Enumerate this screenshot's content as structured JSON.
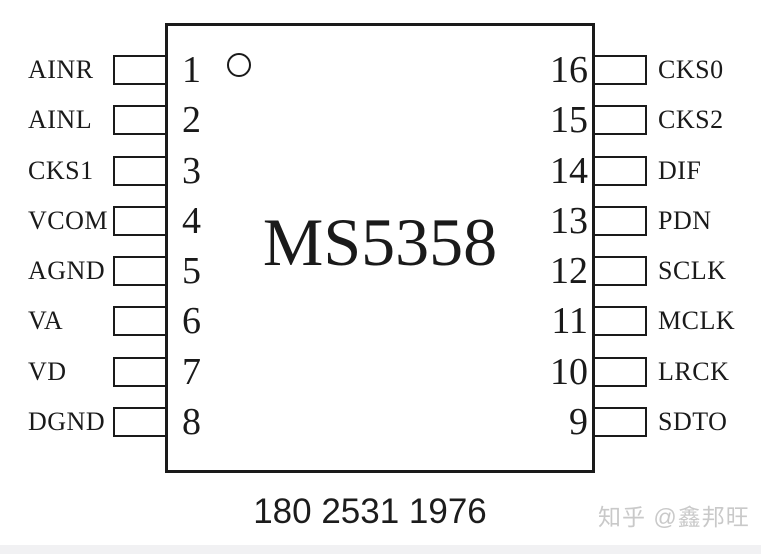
{
  "chip": {
    "title": "MS5358"
  },
  "pins": {
    "left": [
      {
        "number": "1",
        "label": "AINR"
      },
      {
        "number": "2",
        "label": "AINL"
      },
      {
        "number": "3",
        "label": "CKS1"
      },
      {
        "number": "4",
        "label": "VCOM"
      },
      {
        "number": "5",
        "label": "AGND"
      },
      {
        "number": "6",
        "label": "VA"
      },
      {
        "number": "7",
        "label": "VD"
      },
      {
        "number": "8",
        "label": "DGND"
      }
    ],
    "right": [
      {
        "number": "16",
        "label": "CKS0"
      },
      {
        "number": "15",
        "label": "CKS2"
      },
      {
        "number": "14",
        "label": "DIF"
      },
      {
        "number": "13",
        "label": "PDN"
      },
      {
        "number": "12",
        "label": "SCLK"
      },
      {
        "number": "11",
        "label": "MCLK"
      },
      {
        "number": "10",
        "label": "LRCK"
      },
      {
        "number": "9",
        "label": "SDTO"
      }
    ]
  },
  "footer": {
    "phone": "180 2531 1976"
  },
  "watermark": {
    "text": "知乎 @鑫邦旺"
  },
  "colors": {
    "line": "#1a1a1a",
    "watermark_gray": "#c9c9c9",
    "bottom_band": "#f1f1f3"
  }
}
